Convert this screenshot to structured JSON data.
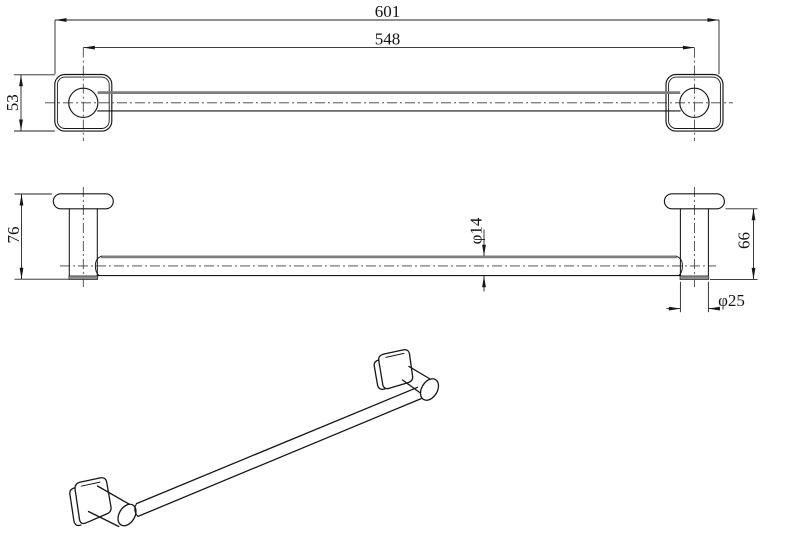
{
  "dimensions": {
    "front_view": {
      "overall_width": "601",
      "post_spacing": "548",
      "plate_size": "53"
    },
    "top_view": {
      "overall_depth": "76",
      "post_depth": "66",
      "bar_diameter": "φ14",
      "post_diameter": "φ25"
    }
  }
}
